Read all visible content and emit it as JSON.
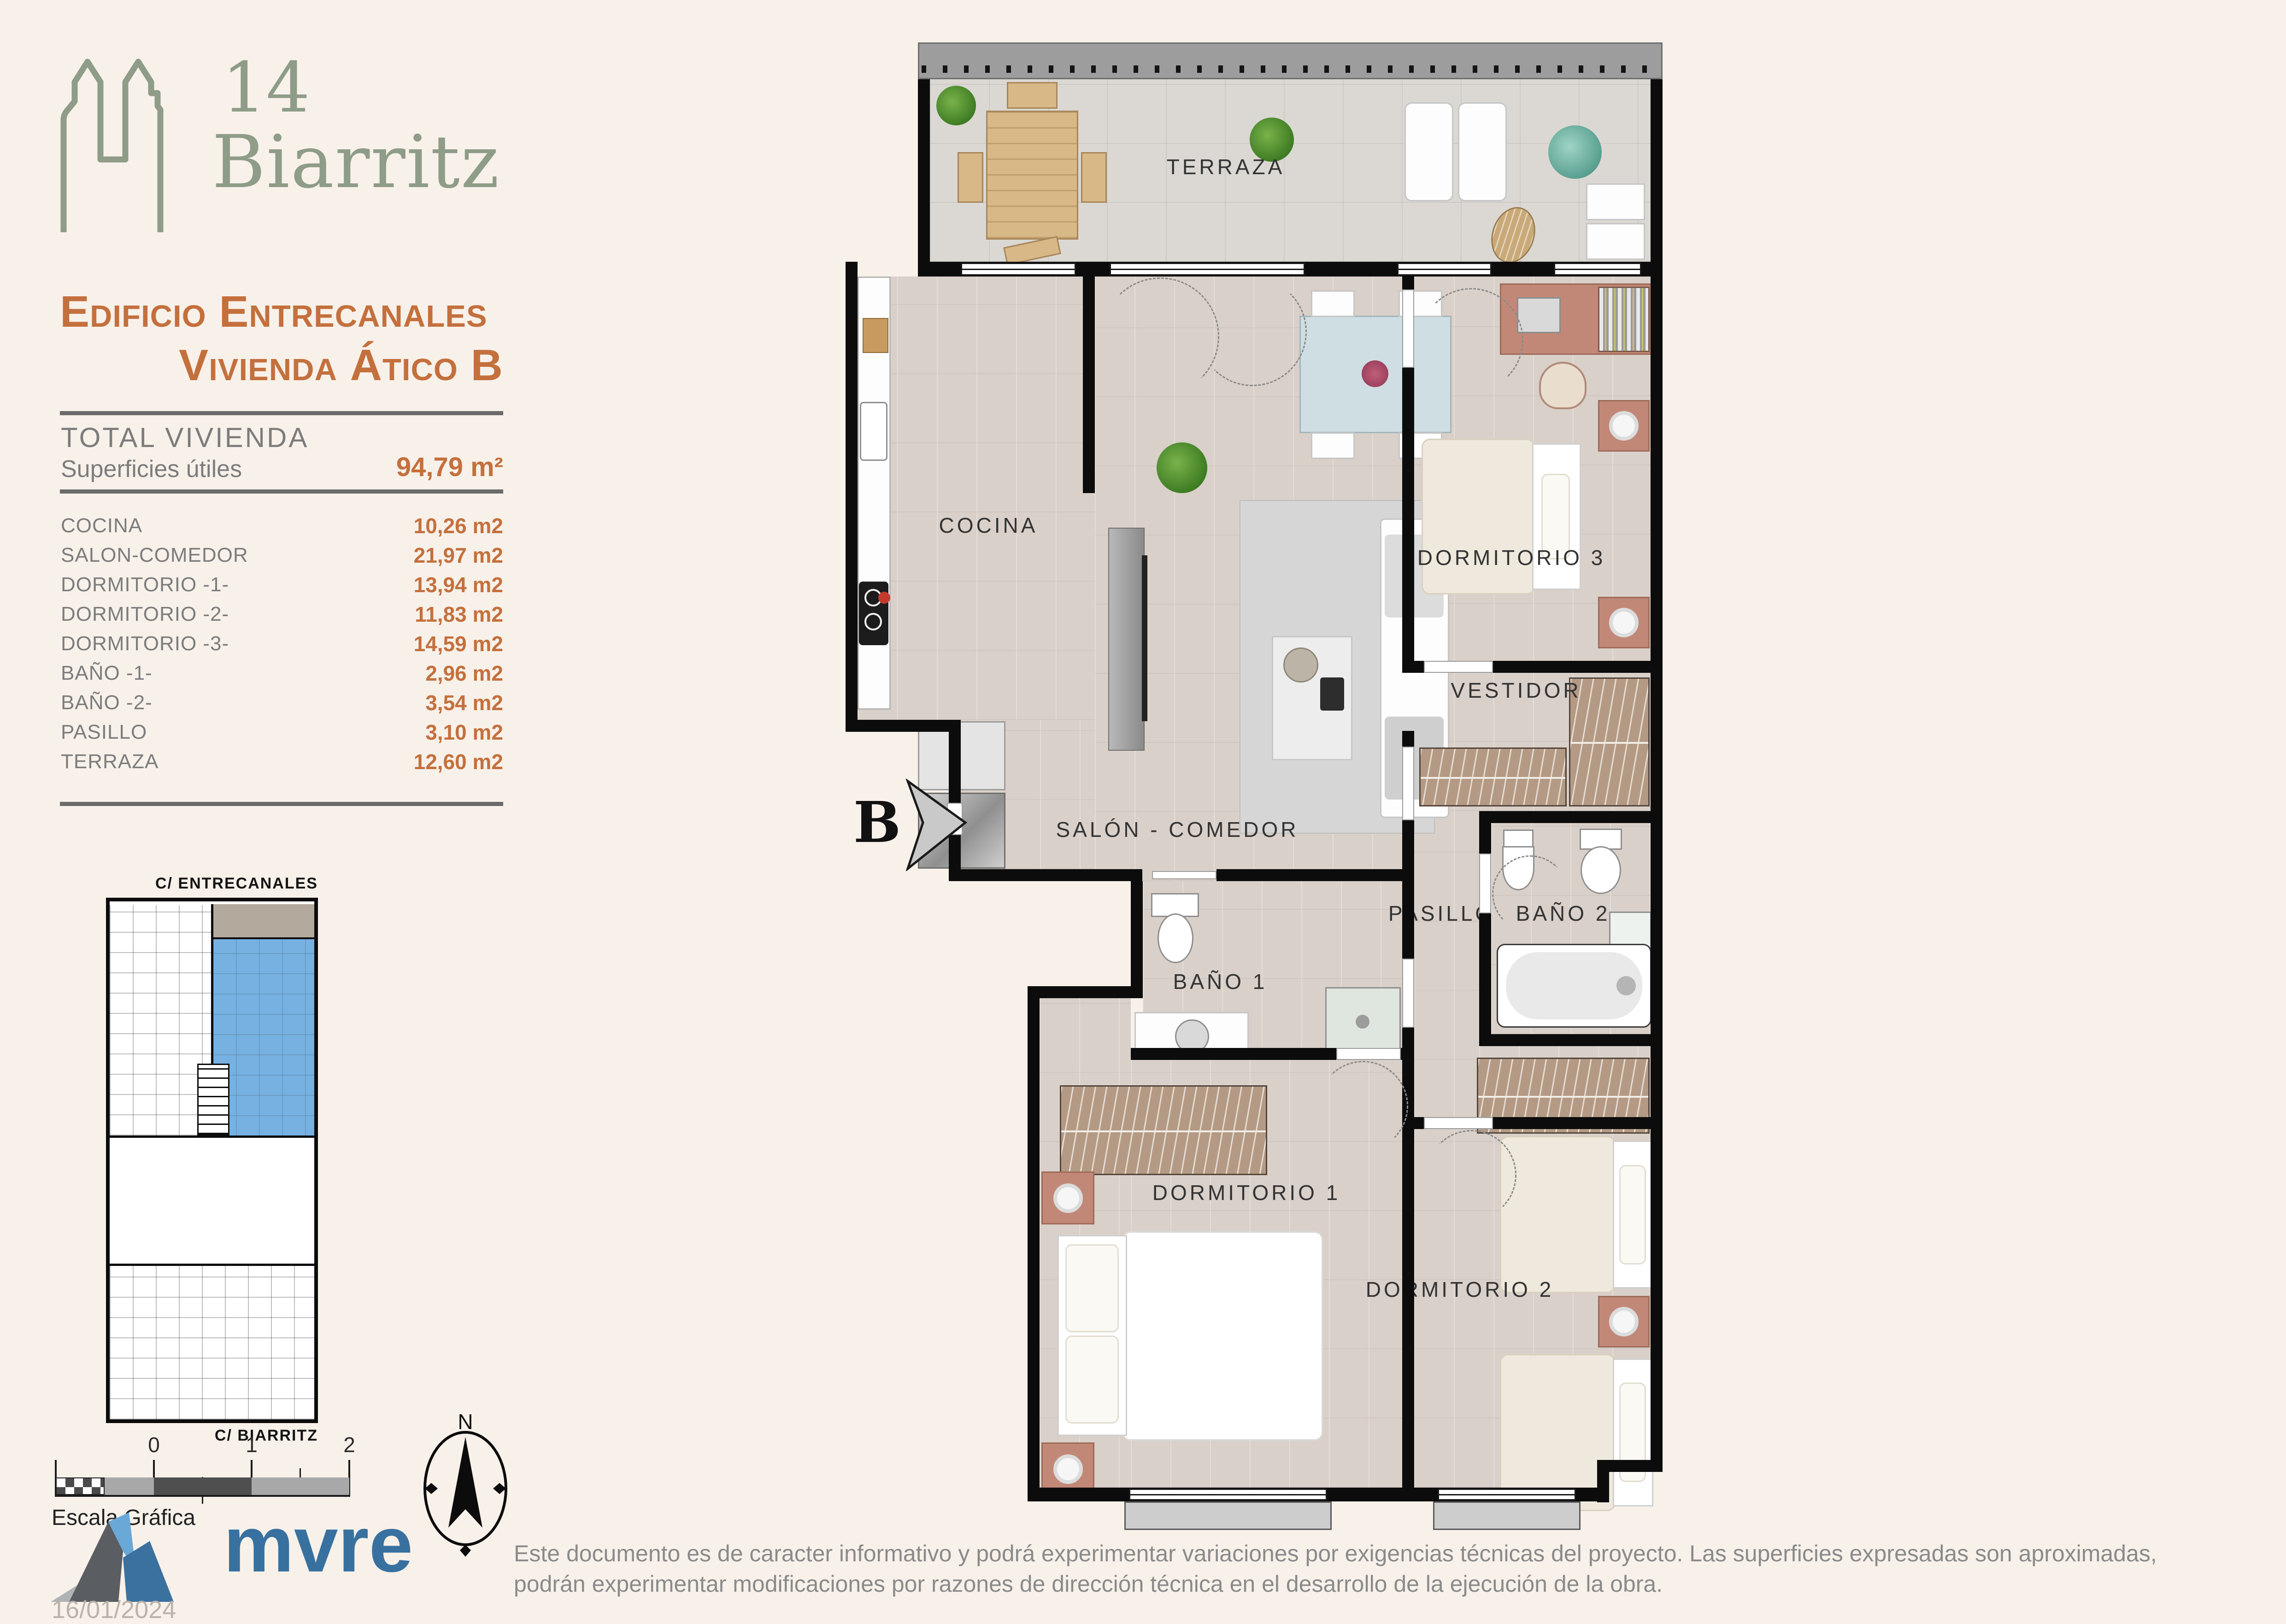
{
  "brand": {
    "number": "14",
    "name": "Biarritz"
  },
  "header": {
    "building": "Edificio Entrecanales",
    "unit": "Vivienda Ático B"
  },
  "summary": {
    "total_label": "TOTAL VIVIENDA",
    "surfaces_label": "Superficies útiles",
    "total_value": "94,79 m²"
  },
  "rooms": [
    {
      "label": "COCINA",
      "value": "10,26 m2"
    },
    {
      "label": "SALON-COMEDOR",
      "value": "21,97 m2"
    },
    {
      "label": "DORMITORIO -1-",
      "value": "13,94 m2"
    },
    {
      "label": "DORMITORIO -2-",
      "value": "11,83 m2"
    },
    {
      "label": "DORMITORIO -3-",
      "value": "14,59 m2"
    },
    {
      "label": "BAÑO -1-",
      "value": "2,96 m2"
    },
    {
      "label": "BAÑO -2-",
      "value": "3,54 m2"
    },
    {
      "label": "PASILLO",
      "value": "3,10 m2"
    },
    {
      "label": "TERRAZA",
      "value": "12,60 m2"
    }
  ],
  "key_plan": {
    "street_top": "C/ ENTRECANALES",
    "street_bottom": "C/ BIARRITZ"
  },
  "scale_bar": {
    "label": "Escala Gráfica",
    "ticks": [
      "0",
      "1",
      "2"
    ]
  },
  "compass": {
    "north_label": "N"
  },
  "plan": {
    "rooms": {
      "terraza": "TERRAZA",
      "cocina": "COCINA",
      "salon": "SALÓN - COMEDOR",
      "dormitorio1": "DORMITORIO 1",
      "dormitorio2": "DORMITORIO 2",
      "dormitorio3": "DORMITORIO 3",
      "vestidor": "VESTIDOR",
      "pasillo": "PASILLO",
      "bano1": "BAÑO 1",
      "bano2": "BAÑO 2"
    },
    "entrance_label": "B"
  },
  "footer": {
    "logo_text": "mvre",
    "date": "16/01/2024",
    "disclaimer": "Este documento es de caracter informativo y podrá experimentar variaciones por exigencias técnicas del proyecto. Las superficies expresadas son aproximadas, podrán experimentar modificaciones por razones de dirección técnica en el desarrollo de la ejecución de la obra."
  },
  "colors": {
    "accent_orange": "#c4703d",
    "brand_sage": "#8e9c88",
    "highlight_blue": "#76b1e2",
    "logo_blue": "#38719f",
    "background": "#f8f1ea"
  }
}
